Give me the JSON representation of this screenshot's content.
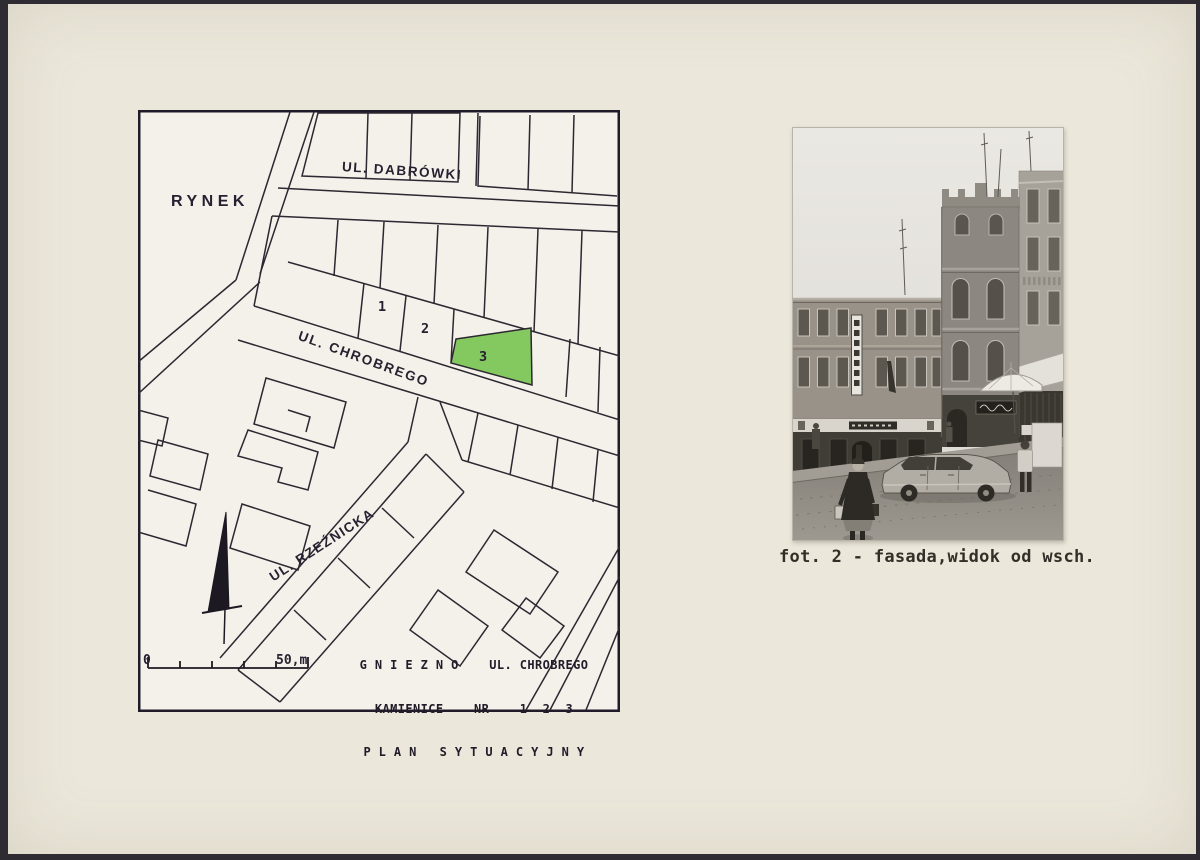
{
  "map": {
    "area_label": "RYNEK",
    "streets": {
      "dabrowki": "UL. DABRÓWKI",
      "chrobrego": "UL. CHROBREGO",
      "rzeznicka": "UL. RZEŹNICKA"
    },
    "parcels": {
      "p1": "1",
      "p2": "2",
      "p3": "3"
    },
    "highlight_color": "#84c95f",
    "scale": {
      "zero": "0",
      "end": "50,m"
    },
    "title": {
      "line1": "G N I E Z N O    UL. CHROBREGO",
      "line2": "KAMIENICE    NR    1  2  3",
      "line3": "P L A N   S Y T U A C Y J N Y"
    },
    "icons": {
      "north_arrow": "north-arrow"
    }
  },
  "photo": {
    "caption": "fot. 2 - fasada,widok od wsch."
  }
}
